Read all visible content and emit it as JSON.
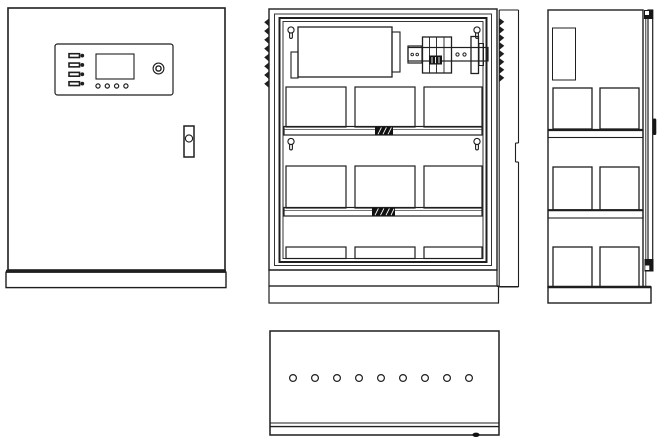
{
  "drawing": {
    "background": "#ffffff",
    "line_color": "#1f1f1f",
    "views": {
      "front": {
        "label": "cabinet-front-view",
        "control_panel": {
          "led_rows": 4,
          "buttons": 4,
          "has_display": true,
          "has_knob": true
        },
        "has_door_handle": true,
        "has_base_plinth": true
      },
      "internal": {
        "label": "cabinet-internal-view",
        "battery_rows": 3,
        "batteries_per_row": 3,
        "mounting_keyholes": 4,
        "hinge_teeth_left": 8,
        "hinge_teeth_right": 8,
        "shelves": 2,
        "has_top_module": true,
        "has_breaker_assembly": true,
        "has_open_door_edge": true
      },
      "side": {
        "label": "cabinet-side-view",
        "battery_rows": 3,
        "batteries_per_row": 2,
        "shelves": 2,
        "has_top_module": true,
        "has_door_edge_bar": true,
        "has_handle_bump": true
      },
      "bottom": {
        "label": "cabinet-bottom-view",
        "vent_holes": 9
      }
    }
  }
}
